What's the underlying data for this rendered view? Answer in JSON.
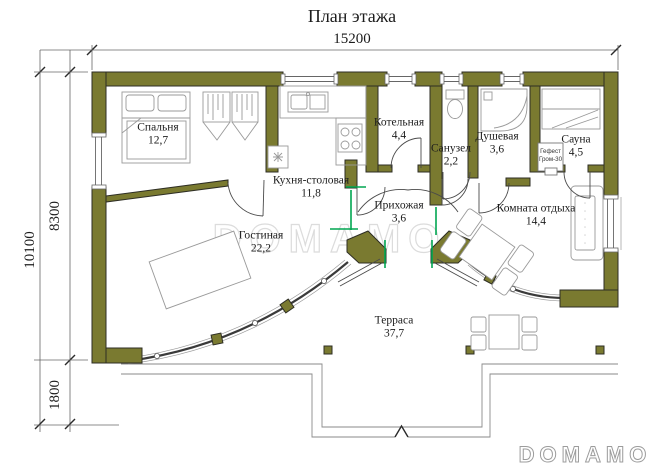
{
  "title": "План этажа",
  "watermark": "DOMAMO",
  "brand": "DOMAMO",
  "dimensions": {
    "top_width": "15200",
    "left_total": "10100",
    "left_house": "8300",
    "left_terrace": "1800"
  },
  "rooms": {
    "bedroom": {
      "name": "Спальня",
      "area": "12,7"
    },
    "kitchen": {
      "name": "Кухня-столовая",
      "area": "11,8"
    },
    "boiler": {
      "name": "Котельная",
      "area": "4,4"
    },
    "wc": {
      "name": "Санузел",
      "area": "2,2"
    },
    "shower": {
      "name": "Душевая",
      "area": "3,6"
    },
    "sauna": {
      "name": "Сауна",
      "area": "4,5"
    },
    "hallway": {
      "name": "Прихожая",
      "area": "3,6"
    },
    "living": {
      "name": "Гостиная",
      "area": "22,2"
    },
    "rest": {
      "name": "Комната отдыха",
      "area": "14,4"
    },
    "terrace": {
      "name": "Терраса",
      "area": "37,7"
    }
  },
  "sauna_stove": {
    "line1": "Гефест",
    "line2": "Гром-30"
  },
  "colors": {
    "wall": "#7a7a30",
    "accent": "#00a651",
    "watermark": "#dcdcdc",
    "logo": "#9c9c9c"
  }
}
